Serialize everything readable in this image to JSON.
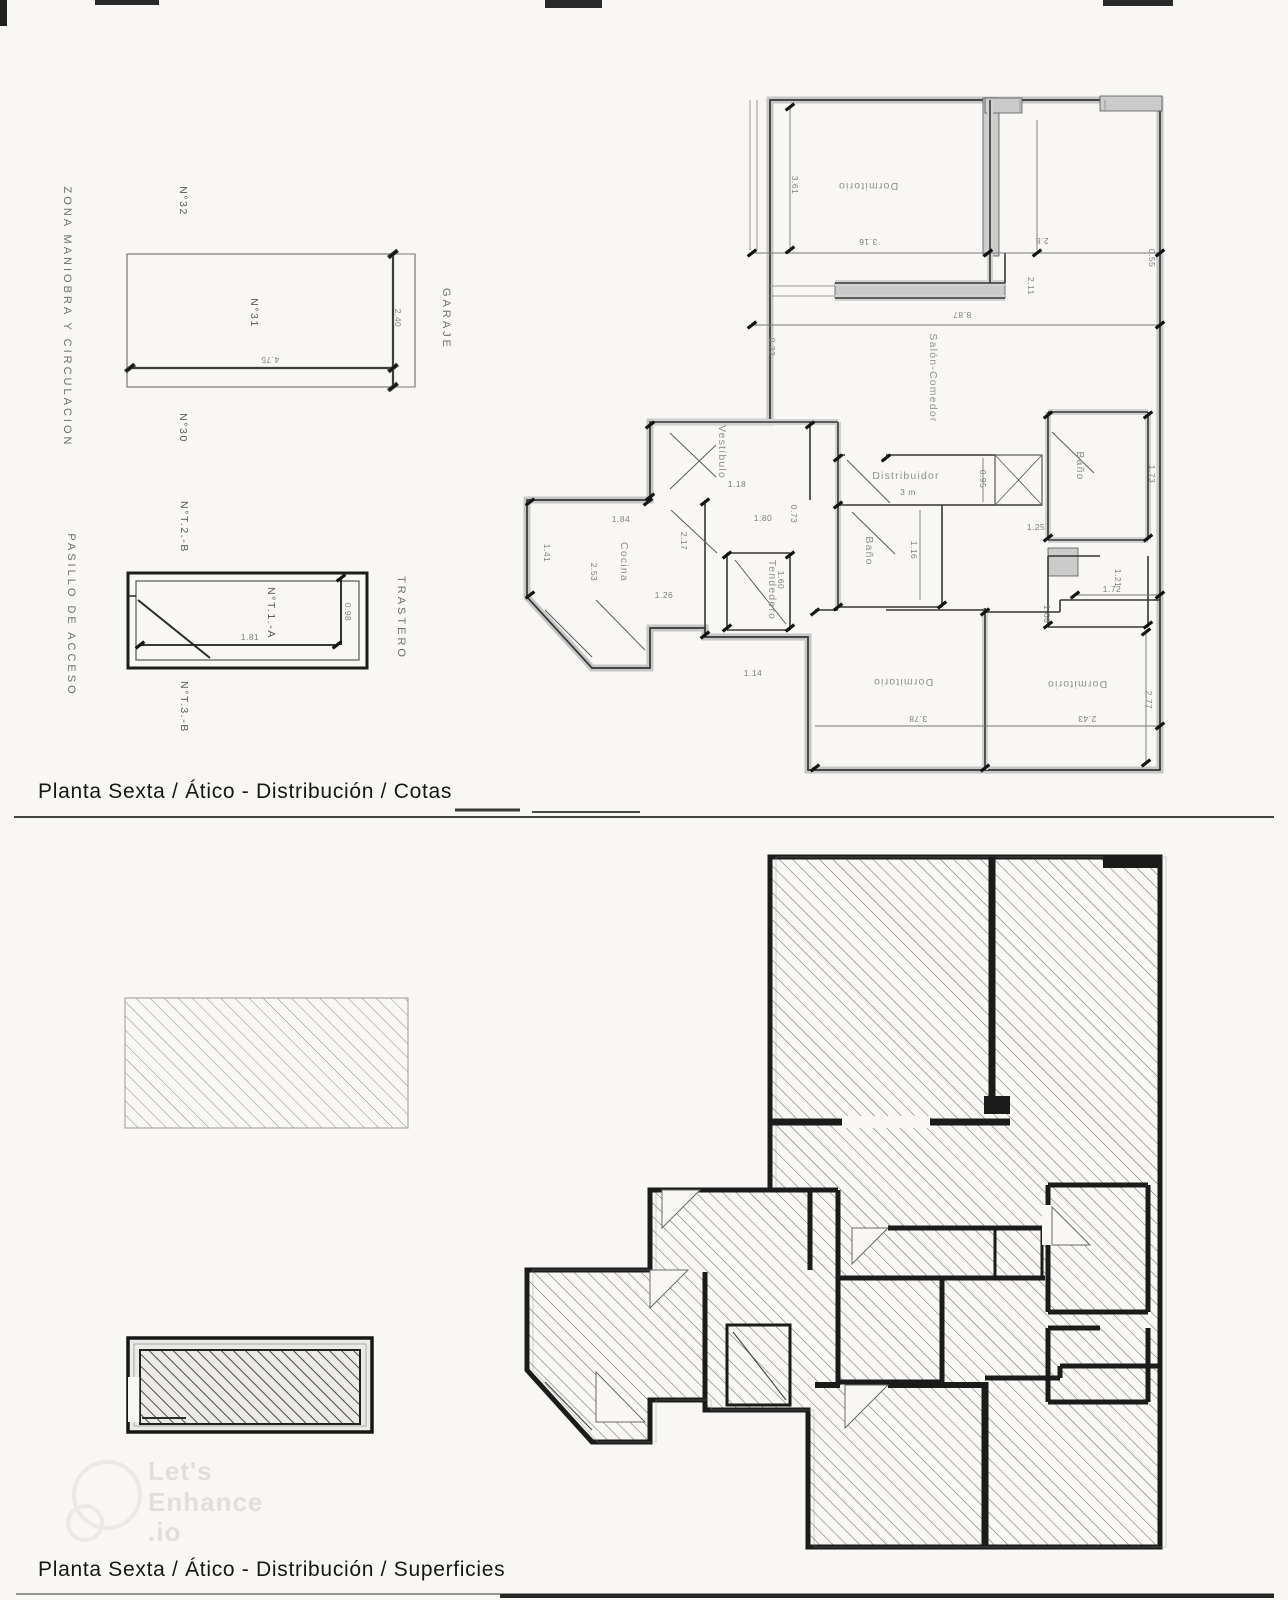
{
  "titles": {
    "cotas": "Planta Sexta / Ático - Distribución / Cotas",
    "superficies": "Planta Sexta / Ático - Distribución / Superficies"
  },
  "watermark": {
    "line1": "Let's",
    "line2": "Enhance",
    "line3": ".io"
  },
  "colors": {
    "paper": "#f8f7f4",
    "wall_dark": "#2f2f2f",
    "wall_poche": "#cccccc",
    "dim_gray": "#7d7d7d",
    "hatch_gray": "#6f6f6f"
  },
  "positioned_labels": [
    {
      "name": "zone-label",
      "class": "lbl-zone",
      "items": [
        {
          "t": "ZONA MANIOBRA Y CIRCULACION",
          "x": 67,
          "y": 317,
          "r": 90
        },
        {
          "t": "PASILLO DE ACCESO",
          "x": 71,
          "y": 615,
          "r": 90
        },
        {
          "t": "GARAJE",
          "x": 446,
          "y": 319,
          "r": 90
        },
        {
          "t": "TRASTERO",
          "x": 401,
          "y": 618,
          "r": 90
        }
      ]
    },
    {
      "name": "parking-unit-label",
      "class": "lbl-unit",
      "items": [
        {
          "t": "N°32",
          "x": 183,
          "y": 201,
          "r": 90
        },
        {
          "t": "N°31",
          "x": 254,
          "y": 313,
          "r": 90
        },
        {
          "t": "N°30",
          "x": 183,
          "y": 428,
          "r": 90
        },
        {
          "t": "N°T.2.-B",
          "x": 184,
          "y": 527,
          "r": 90
        },
        {
          "t": "N°T.1.-A",
          "x": 271,
          "y": 613,
          "r": 90
        },
        {
          "t": "N°T.3.-B",
          "x": 184,
          "y": 707,
          "r": 90
        }
      ]
    },
    {
      "name": "room-label",
      "class": "lbl-room",
      "items": [
        {
          "t": "Dormitorio",
          "x": 868,
          "y": 186,
          "r": 180
        },
        {
          "t": "Salón-Comedor",
          "x": 933,
          "y": 378,
          "r": 90
        },
        {
          "t": "Vestíbulo",
          "x": 722,
          "y": 452,
          "r": 90
        },
        {
          "t": "Distribuidor",
          "x": 906,
          "y": 476,
          "r": 0
        },
        {
          "t": "Cocina",
          "x": 624,
          "y": 562,
          "r": 90
        },
        {
          "t": "Tendedero",
          "x": 772,
          "y": 590,
          "r": 90
        },
        {
          "t": "Baño",
          "x": 869,
          "y": 551,
          "r": 90
        },
        {
          "t": "Baño",
          "x": 1080,
          "y": 466,
          "r": 90
        },
        {
          "t": "Dormitorio",
          "x": 903,
          "y": 682,
          "r": 180
        },
        {
          "t": "Dormitorio",
          "x": 1077,
          "y": 684,
          "r": 180
        }
      ]
    },
    {
      "name": "dim-label",
      "class": "lbl-dim",
      "items": [
        {
          "t": "3.61",
          "x": 795,
          "y": 185,
          "r": 90
        },
        {
          "t": "3.16",
          "x": 868,
          "y": 242,
          "r": 180
        },
        {
          "t": "2.8",
          "x": 1042,
          "y": 241,
          "r": 180
        },
        {
          "t": "0.55",
          "x": 1152,
          "y": 258,
          "r": 90
        },
        {
          "t": "8.87",
          "x": 962,
          "y": 315,
          "r": 180
        },
        {
          "t": "2.11",
          "x": 1031,
          "y": 286,
          "r": 90
        },
        {
          "t": "0.22",
          "x": 772,
          "y": 347,
          "r": 90
        },
        {
          "t": "1.18",
          "x": 737,
          "y": 484,
          "r": 0
        },
        {
          "t": "1.80",
          "x": 763,
          "y": 518,
          "r": 0
        },
        {
          "t": "0.73",
          "x": 794,
          "y": 514,
          "r": 90
        },
        {
          "t": "1.84",
          "x": 621,
          "y": 519,
          "r": 0
        },
        {
          "t": "1.41",
          "x": 547,
          "y": 553,
          "r": 90
        },
        {
          "t": "2.53",
          "x": 594,
          "y": 572,
          "r": 90
        },
        {
          "t": "2.17",
          "x": 684,
          "y": 541,
          "r": 90
        },
        {
          "t": "1.26",
          "x": 664,
          "y": 595,
          "r": 0
        },
        {
          "t": "1.14",
          "x": 753,
          "y": 673,
          "r": 0
        },
        {
          "t": "1.60",
          "x": 781,
          "y": 580,
          "r": 90
        },
        {
          "t": "3 m",
          "x": 908,
          "y": 492,
          "r": 0
        },
        {
          "t": "0.95",
          "x": 983,
          "y": 479,
          "r": 90
        },
        {
          "t": "1.16",
          "x": 914,
          "y": 550,
          "r": 90
        },
        {
          "t": "1.25",
          "x": 1036,
          "y": 527,
          "r": 0
        },
        {
          "t": "1.73",
          "x": 1152,
          "y": 474,
          "r": 90
        },
        {
          "t": "1.21",
          "x": 1118,
          "y": 578,
          "r": 90
        },
        {
          "t": "1.72",
          "x": 1112,
          "y": 589,
          "r": 0
        },
        {
          "t": "1.68",
          "x": 1047,
          "y": 614,
          "r": 90
        },
        {
          "t": "2.77",
          "x": 1149,
          "y": 700,
          "r": 90
        },
        {
          "t": "3.78",
          "x": 918,
          "y": 719,
          "r": 180
        },
        {
          "t": "2.43",
          "x": 1087,
          "y": 719,
          "r": 180
        },
        {
          "t": "4.75",
          "x": 270,
          "y": 360,
          "r": 180
        },
        {
          "t": "2.40",
          "x": 398,
          "y": 318,
          "r": 90
        },
        {
          "t": "1.81",
          "x": 250,
          "y": 637,
          "r": 0
        },
        {
          "t": "0.98",
          "x": 348,
          "y": 612,
          "r": 90
        }
      ]
    }
  ]
}
